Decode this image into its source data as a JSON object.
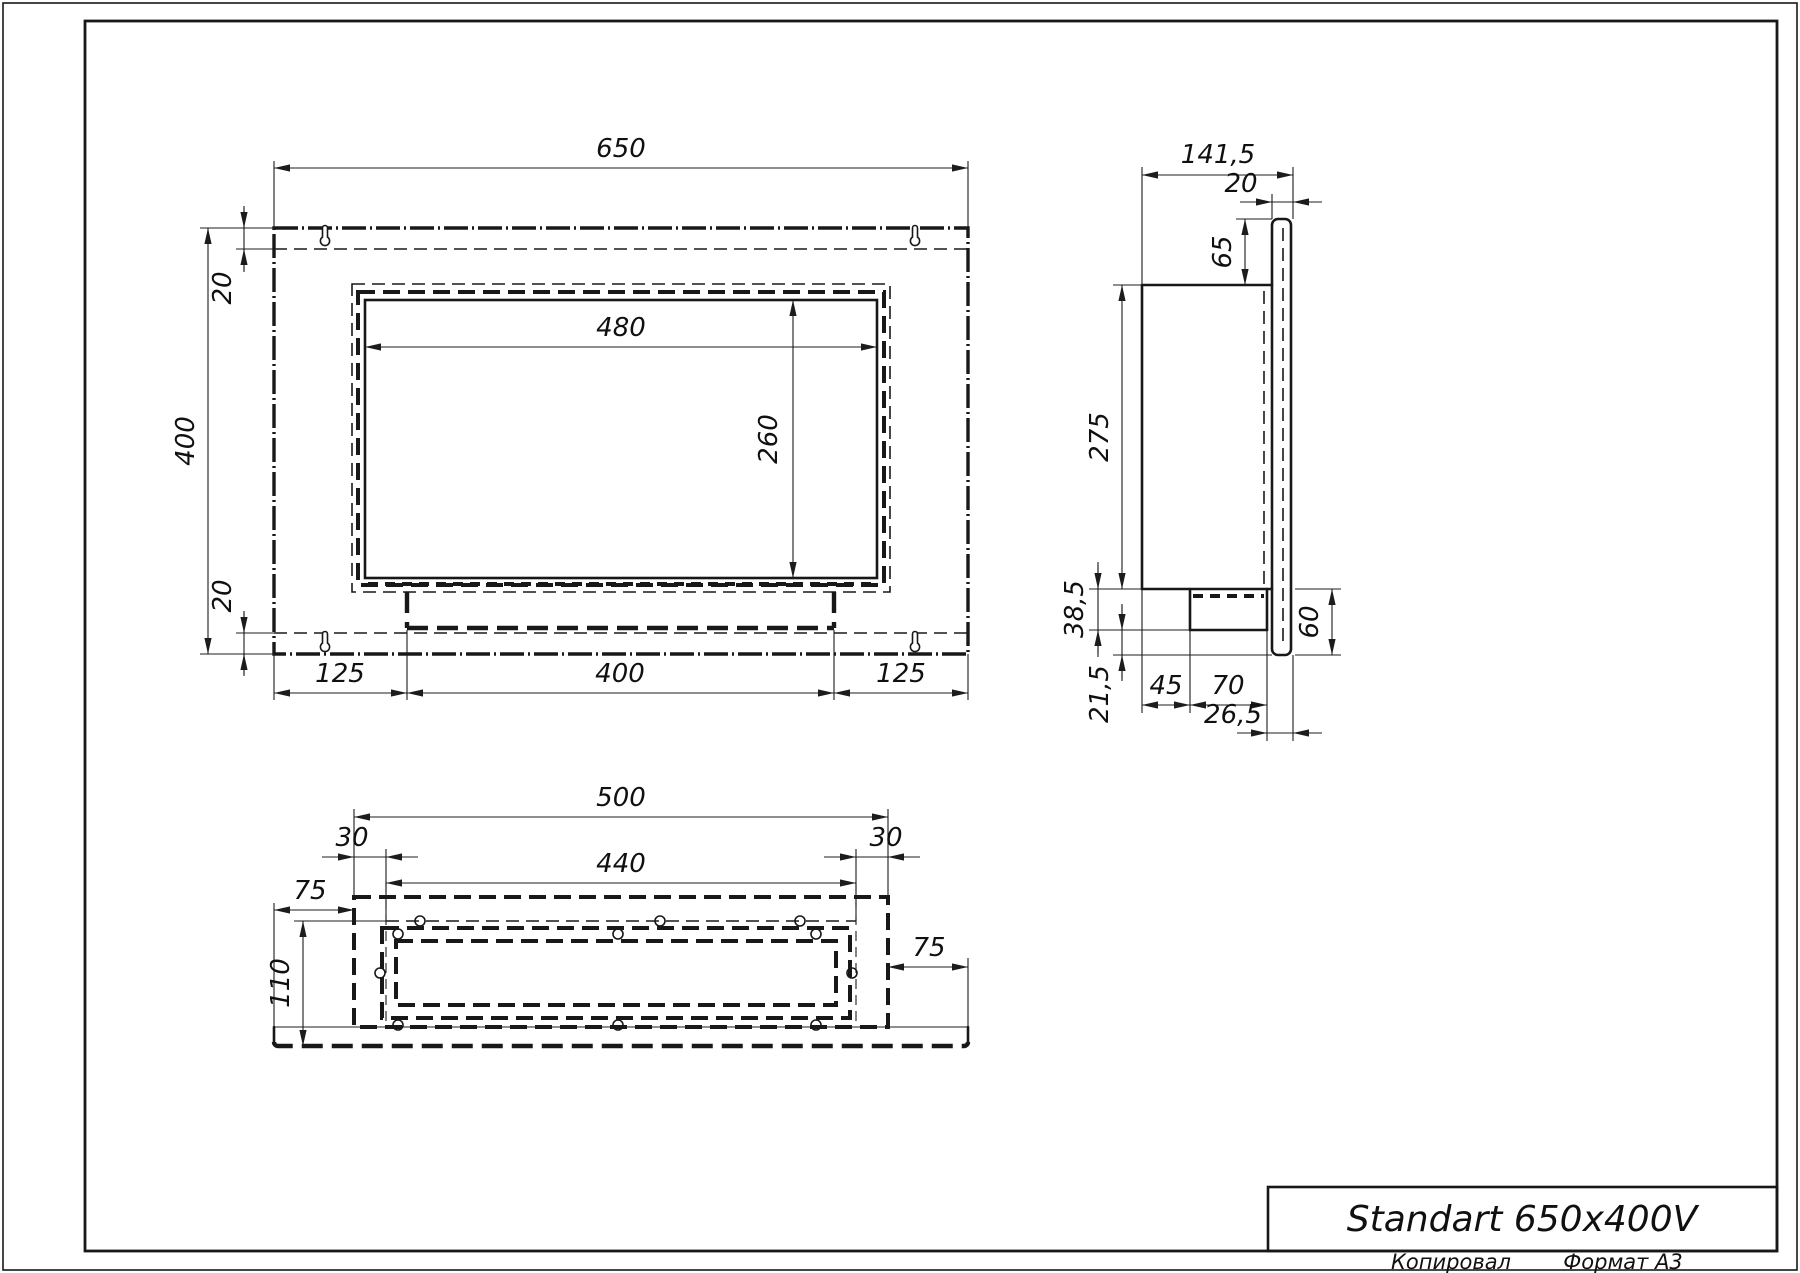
{
  "drawing": {
    "title": "Standart 650x400V",
    "footer": {
      "left": "Копировал",
      "right": "Формат А3"
    },
    "line_color": "#181818",
    "icons": {
      "mount_slot": "keyhole-icon"
    },
    "front_view": {
      "dims": {
        "width": "650",
        "height": "400",
        "opening_width": "480",
        "opening_height": "260",
        "margin_top": "20",
        "margin_bottom": "20",
        "bottom_left": "125",
        "bottom_center": "400",
        "bottom_right": "125"
      }
    },
    "side_view": {
      "dims": {
        "depth": "141,5",
        "flange_offset": "20",
        "top_offset": "65",
        "body_depth": "275",
        "burner_drop": "38,5",
        "bottom_gap": "21,5",
        "front_gap": "45",
        "burner_width": "70",
        "rear_gap": "26,5",
        "flange_drop": "60"
      }
    },
    "bottom_view": {
      "dims": {
        "casing_width": "500",
        "inset_left": "30",
        "inner_width": "440",
        "inset_right": "30",
        "flange_left": "75",
        "flange_right": "75",
        "inner_depth": "110"
      }
    }
  }
}
